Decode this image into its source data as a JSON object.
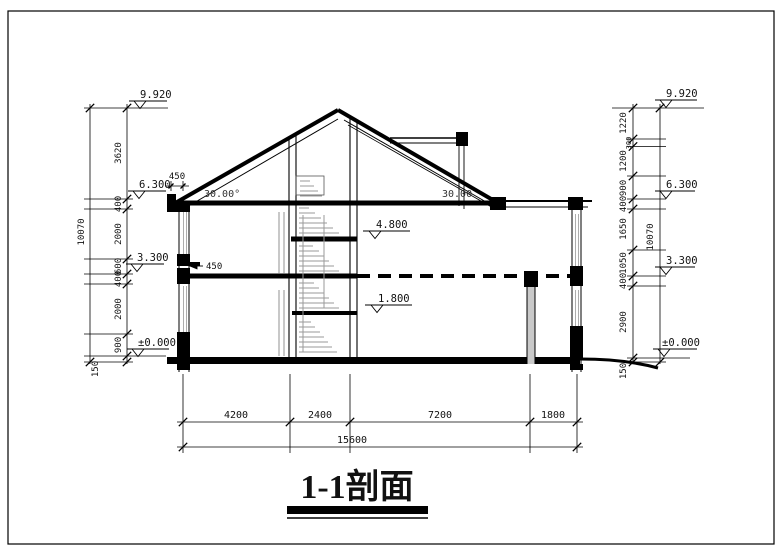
{
  "title": "1-1剖面",
  "left": {
    "total": "10070",
    "chain": [
      "3620",
      "400",
      "2000",
      "600",
      "400",
      "2000",
      "900",
      "150"
    ],
    "elev_ridge": "9.920",
    "elev_eave": "6.300",
    "elev_floor2": "3.300",
    "elev_ground": "±0.000",
    "eave_overhang": "450",
    "roof_angle": "30.00°",
    "ledge": "450"
  },
  "right": {
    "total": "10070",
    "chain": [
      "1220",
      "300",
      "1200",
      "900",
      "400",
      "1650",
      "1050",
      "400",
      "2900",
      "150"
    ],
    "elev_ridge": "9.920",
    "elev_eave": "6.300",
    "elev_floor2": "3.300",
    "elev_ground": "±0.000",
    "roof_angle": "30.00"
  },
  "middle": {
    "elev_landing_upper": "4.800",
    "elev_landing_lower": "1.800"
  },
  "bottom": {
    "chain": [
      "4200",
      "2400",
      "7200",
      "1800"
    ],
    "total": "15600"
  }
}
